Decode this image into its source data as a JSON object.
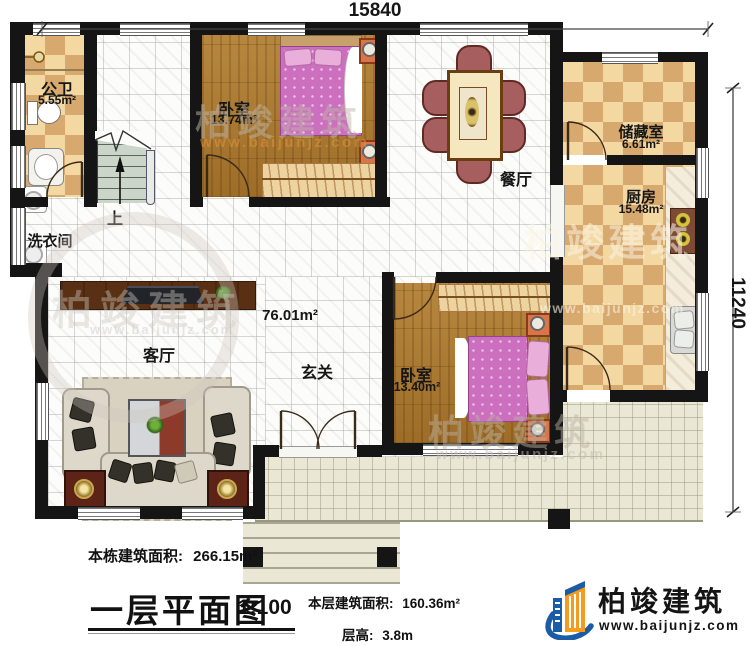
{
  "dimensions": {
    "top": "15840",
    "right": "11240"
  },
  "rooms": {
    "bathroom": {
      "name": "公卫",
      "area": "5.55m²"
    },
    "bedroom1": {
      "name": "卧室",
      "area": "13.74m²"
    },
    "dining": {
      "name": "餐厅"
    },
    "storage": {
      "name": "储藏室",
      "area": "6.61m²"
    },
    "kitchen": {
      "name": "厨房",
      "area": "15.48m²"
    },
    "laundry": {
      "name": "洗衣间"
    },
    "stairs": {
      "label": "上"
    },
    "hall": {
      "area": "76.01m²"
    },
    "living": {
      "name": "客厅"
    },
    "foyer": {
      "name": "玄关"
    },
    "bedroom2": {
      "name": "卧室",
      "area": "13.40m²"
    }
  },
  "annotations": {
    "total_area_label": "本栋建筑面积:",
    "total_area_value": "266.15m²",
    "plan_title": "一层平面图",
    "plan_scale": "1:100",
    "floor_area_label": "本层建筑面积:",
    "floor_area_value": "160.36m²",
    "floor_height_label": "层高:",
    "floor_height_value": "3.8m"
  },
  "branding": {
    "company": "柏竣建筑",
    "website": "www.baijunjz.com"
  },
  "watermark": {
    "company": "柏竣建筑",
    "website": "www.baijunjz.com"
  },
  "colors": {
    "wall": "#151515",
    "checker_light": "#f3d8a2",
    "checker_dark": "#d8a96e",
    "wood": "#ab7a33",
    "terrace_tile": "#eae7d4",
    "bed_pink": "#cc6fbe",
    "chair_red": "#a65f5e",
    "logo_blue": "#1b5ca6",
    "logo_orange": "#f59b1e"
  }
}
